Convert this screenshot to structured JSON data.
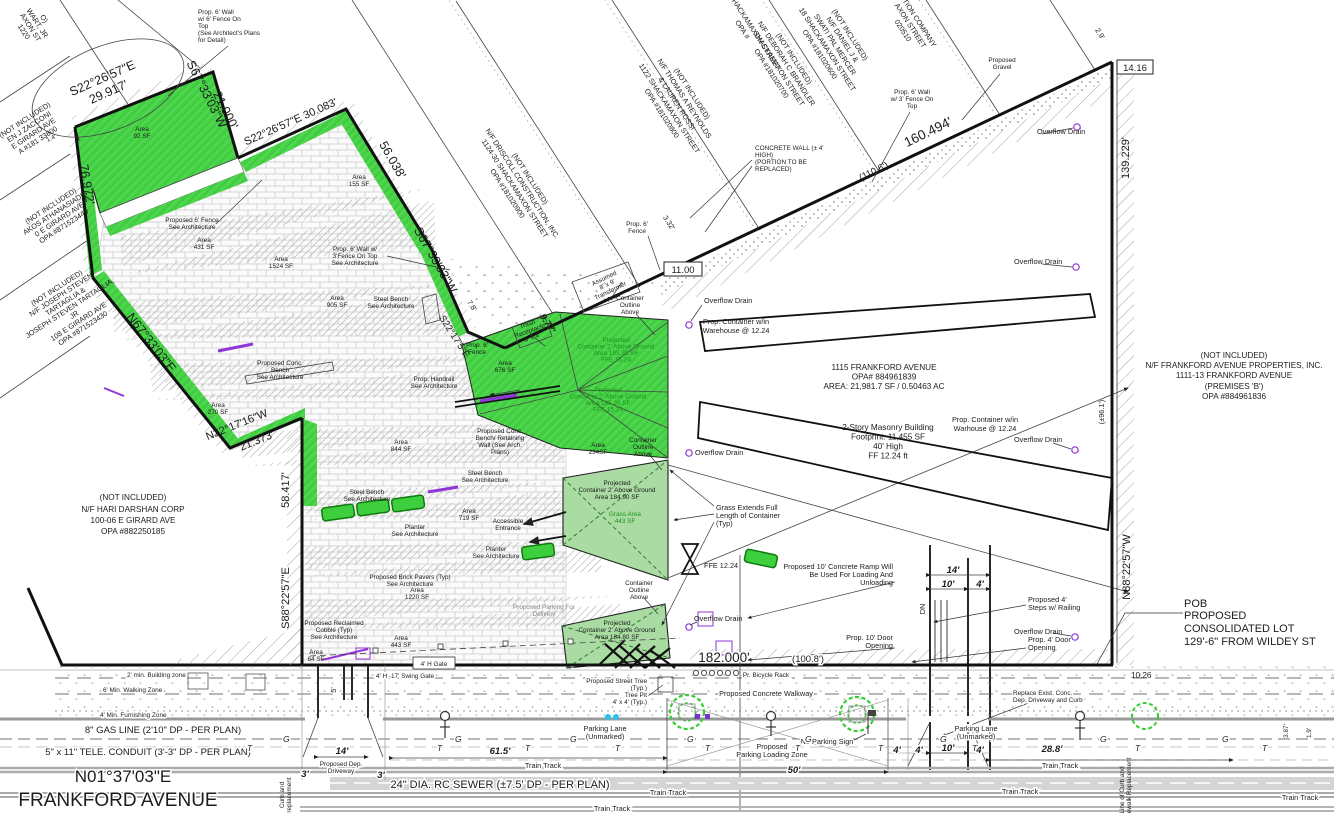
{
  "colors": {
    "green": "#46d146",
    "green_light": "#a9dba3",
    "green_dark": "#1e941e",
    "purple": "#9134d8",
    "cyan": "#27c3ee",
    "ink": "#1c1c1c"
  },
  "info": {
    "l1": "1115 FRANKFORD AVENUE",
    "l2": "OPA# 884961839",
    "l3": "AREA: 21,981.7 SF / 0.50463 AC"
  },
  "bldg": {
    "l1": "2-Story Masonry Building",
    "l2": "Footprint: 11,455 SF",
    "l3": "40' High",
    "l4": "FF 12.24 ft"
  },
  "pob": {
    "l1": "POB",
    "l2": "PROPOSED",
    "l3": "CONSOLIDATED LOT",
    "l4": "129'-6\" FROM WILDEY ST"
  },
  "bearings": {
    "b1a": "S22°26'57\"E",
    "b1b": "29.917'",
    "b2a": "S67°33'03\"W",
    "b2b": "21.000'",
    "b3": "S22°26'57\"E 30.083'",
    "b4": "56.038'",
    "b5": "S67°33'03\"W",
    "b6": "76.972'",
    "b7": "N67°33'03\"E",
    "b8a": "N22°17'16\"W",
    "b8b": "21.373'",
    "b9": "58.417'",
    "b10": "S88°22'57\"E",
    "b11": "S22°17'5\"E",
    "b12": "160.494'",
    "b13": "(110.6')",
    "b14": "139.229'",
    "b15": "(±96.1')",
    "b16": "N88°22'57\"W",
    "b17": "182.000'",
    "b18": "(100.8')",
    "b19": "10.26",
    "b20": "2.9'",
    "b21": "3.32'",
    "b22": "9.77'",
    "b23": "7.8'",
    "b24": "11.00",
    "b25": "14.16",
    "b26": "1.4'"
  },
  "dims": {
    "ramp14": "14'",
    "ramp10": "10'",
    "ramp4": "4'",
    "dn": "DN",
    "drive14": "14'",
    "drive3L": "3'",
    "drive3R": "3'",
    "d615": "61.5'",
    "d50": "50'",
    "d4a": "4'",
    "d4b": "4'",
    "d10": "10'",
    "d4c": "4'",
    "d288": "28.8'",
    "d5": "5'",
    "v387": "3.87'",
    "v19": "1.9'"
  },
  "parcels": {
    "p1": [
      "O)",
      "WART, JR",
      "AXON ST",
      "1220"
    ],
    "p2": [
      "(NOT INCLUDED)",
      "EN J ZACCONI",
      "E GIRARD AVE",
      "A #181 33800"
    ],
    "p3": [
      "(NOT INCLUDED)",
      "AKOS ATHANASIADIS",
      "0 E GIRARD AVE",
      "OPA #871523440"
    ],
    "p4": [
      "(NOT INCLUDED)",
      "N/F JOSEPH STEVEN",
      "TARTAGLIA &",
      "JOSEPH STEVEN TARTAGLIA,",
      "JR",
      "108 E GIRARD AVE",
      "OPA #871523430"
    ],
    "p5": [
      "(NOT INCLUDED)",
      "N/F HARI DARSHAN CORP",
      "100-06 E GIRARD AVE",
      "OPA #882250185"
    ],
    "p6": [
      "(NOT INCLUDED)",
      "N/F DRISCOLL CONSTRUCTION, INC.",
      "1124-30 SHACKAMAXON STREET",
      "OPA #181020900"
    ],
    "p7": [
      "(NOT INCLUDED)",
      "N/F THOMAS A REYNOLDS",
      "& LAUREN ROSSI",
      "1122 SHACKAMAXON STREET",
      "OPA #181020800"
    ],
    "p8": [
      "1120 SHACKAMAXON STREET",
      "OPA #"
    ],
    "p9": [
      "(NOT INCLUDED)",
      "N/F DEBORAH C BRANDLER",
      "SHACKAMAXON STREET",
      "OPA #181020700"
    ],
    "p10": [
      "(NOT INCLUDED)",
      "N/F DANIEL J &",
      "SWATI PAL MERCER",
      "18 SHACKAMAXON STREET",
      "OPA #181020600"
    ],
    "p11": [
      "CTION COMPANY",
      "AXON STREET",
      "020510"
    ],
    "p12": [
      "(NOT INCLUDED)",
      "N/F FRANKFORD AVENUE PROPERTIES, INC.",
      "1111-13 FRANKFORD AVENUE",
      "(PREMISES 'B')",
      "OPA #884961836"
    ]
  },
  "labels": {
    "wall6": [
      "Prop. 6' Wall",
      "w/ 6' Fence On",
      "Top",
      "(See Architect's Plans",
      "for Detail)"
    ],
    "area92": [
      "Area",
      "92 SF"
    ],
    "area431": [
      "Area",
      "431 SF"
    ],
    "area1524": [
      "Area",
      "1524 SF"
    ],
    "area155": [
      "Area",
      "155 SF"
    ],
    "area905": [
      "Area",
      "905 SF"
    ],
    "area270": [
      "Area",
      "270 SF"
    ],
    "area844": [
      "Area",
      "844 SF"
    ],
    "area676": [
      "Area",
      "676 SF"
    ],
    "area719": [
      "Area",
      "719 SF"
    ],
    "area234": [
      "Area",
      "234SF"
    ],
    "area1220": [
      "Area",
      "1220 SF"
    ],
    "area443": [
      "Area",
      "443 SF"
    ],
    "area64": [
      "Area",
      "64 SF"
    ],
    "fence6": [
      "Proposed 6' Fence",
      "See Architecture"
    ],
    "wall3": [
      "Prop. 6' Wall w/",
      "3'Fence On Top",
      "See Architecture"
    ],
    "steelBench": [
      "Steel Bench",
      "See Architecture"
    ],
    "concBench": [
      "Proposed Conc.",
      "Bench",
      "See Architecture"
    ],
    "handrail": [
      "Prop. Handrail",
      "See Architecture"
    ],
    "fence6s": [
      "Prop. 6'",
      "Fence"
    ],
    "trash": [
      "Trash",
      "Receptacle",
      "6' x 4'"
    ],
    "transformer": [
      "Assumed",
      "8' x 9'",
      "Transformer",
      "Area"
    ],
    "contOutline": [
      "Container",
      "Outline",
      "Above"
    ],
    "overflow": "Overflow Drain",
    "warehouse": [
      "Prop. Container w/in",
      "Warehouse @ 12.24"
    ],
    "warhouse": [
      "Prop. Container w/in",
      "Warhouse @ 12.24"
    ],
    "projA": [
      "Projected",
      "Container 2' Above Ground",
      "Area 183.39 SF",
      "FFE 15.24"
    ],
    "projB": [
      "Projected",
      "Container 2' Above Ground",
      "Area 185.20 SF",
      "FFE 15.24"
    ],
    "projC": [
      "Projected",
      "Container 2' Above Ground",
      "Area 184.90 SF"
    ],
    "projD": [
      "Projected",
      "Container 2' Above Ground",
      "Area 184.80 SF"
    ],
    "grassArea": [
      "Grass Area",
      "443 SF"
    ],
    "benchRetain": [
      "Proposed Conc.",
      "Bench/ Retaining",
      "Wall (See Arch.",
      "Plans)"
    ],
    "planter": [
      "Planter",
      "See Architecture"
    ],
    "accessible": [
      "Accessible",
      "Entrance"
    ],
    "grassExt": [
      "Grass Extends Full",
      "Length of Container",
      "(Typ)"
    ],
    "ffe": "FFE 12.24",
    "pavers": [
      "Proposed Brick Pavers (Typ)",
      "See Architecture"
    ],
    "parkDeliv": [
      "Proposed Parking For",
      "Delivery"
    ],
    "cobble": [
      "Proposed Reclaimed",
      "Cobble (Typ)",
      "See Architecture"
    ],
    "gate4": "4' H Gate",
    "swing": "4' H -17' Swing Gate",
    "bike": "Pr. Bicycle Rack",
    "gravel": [
      "Proposed",
      "Gravel"
    ],
    "concwall": [
      "CONCRETE WALL (± 4'",
      "HIGH)",
      "(PORTION TO BE",
      "REPLACED)"
    ],
    "wall3top": [
      "Prop. 6' Wall",
      "w/ 3' Fence On",
      "Top"
    ],
    "ramp": [
      "Proposed 10' Concrete Ramp Will",
      "Be Used For Loading And",
      "Unloading"
    ],
    "steps": [
      "Proposed 4'",
      "Steps w/ Railing"
    ],
    "door10": [
      "Prop. 10' Door",
      "Opening"
    ],
    "door4": [
      "Prop. 4' Door",
      "Opening"
    ]
  },
  "street": {
    "zone2": "2' min. Building zone",
    "zone6": "6' Min. Walking Zone",
    "zone4": "4' Min. Furnishing Zone",
    "gas": "8\" GAS LINE (2'10\" DP - PER PLAN)",
    "tele": "5\" x 11\" TELE. CONDUIT (3'-3\" DP - PER PLAN)",
    "bearing": "N01°37'03\"E",
    "name": "FRANKFORD AVENUE",
    "sewer": "24\" DIA. RC SEWER (±7.5' DP - PER PLAN)",
    "train": "Train Track",
    "parking": [
      "Parking Lane",
      "(Unmarked)"
    ],
    "noparking": "No Parking Sign",
    "loading": [
      "Proposed",
      "Parking Loading Zone"
    ],
    "walkway": "Proposed Concrete Walkway",
    "tree": [
      "Proposed Street Tree",
      "(Typ.)",
      "Tree Pit",
      "4' x 4' (Typ.)"
    ],
    "replace": [
      "Replace Exist. Conc.",
      "Dep. Driveway and Curb"
    ],
    "driveway": [
      "Proposed Dep.",
      "Driveway"
    ],
    "curbrep": [
      "Curb and",
      "replacement"
    ],
    "curbrep2": [
      "Line of Curb and",
      "Sidewalk Replacement"
    ],
    "g": "G",
    "t": "T"
  }
}
